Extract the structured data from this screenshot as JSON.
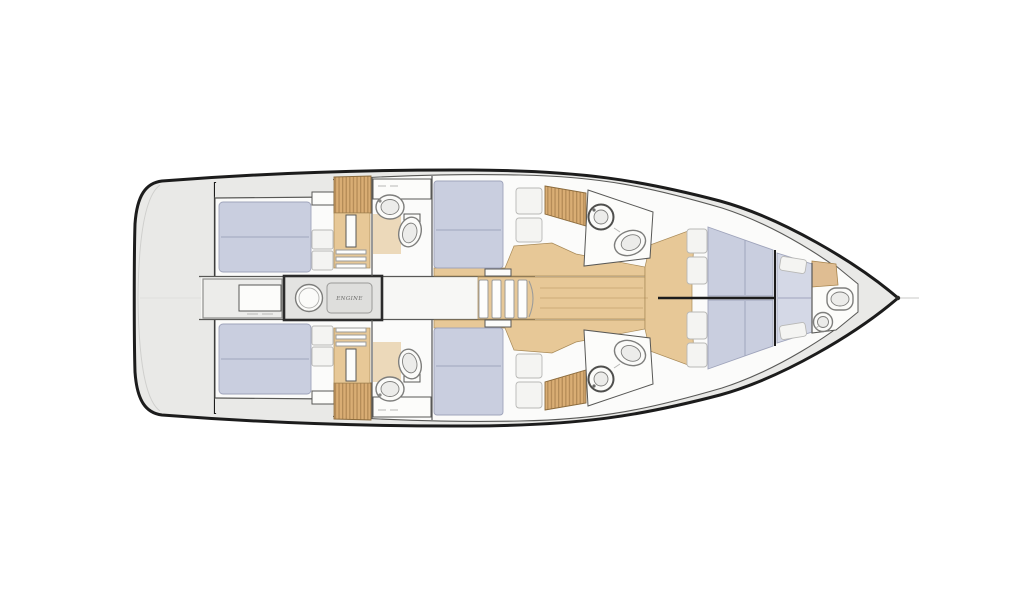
{
  "labels": {
    "engine": "ENGINE"
  },
  "colors": {
    "background": "#ffffff",
    "hull-outline": "#1c1c1c",
    "deck": "#e9e9e7",
    "interior": "#fbfbfa",
    "wall": "#585856",
    "wood-floor": "#e7c897",
    "wood-slats": "#d9ad74",
    "wood-slat-line": "#8f6a3a",
    "bath-tan": "#ecd9ba",
    "mattress": "#c9cedf",
    "mattress-light": "#d4d8e6",
    "seam": "#9fa5bd",
    "cushion": "#f4f4f2",
    "counter": "#ececea",
    "engine-fill": "#e3e3e1",
    "engine-border": "#2b2b2b",
    "fixture-stroke": "#7e7e7c",
    "label-text": "#6a6a68"
  }
}
